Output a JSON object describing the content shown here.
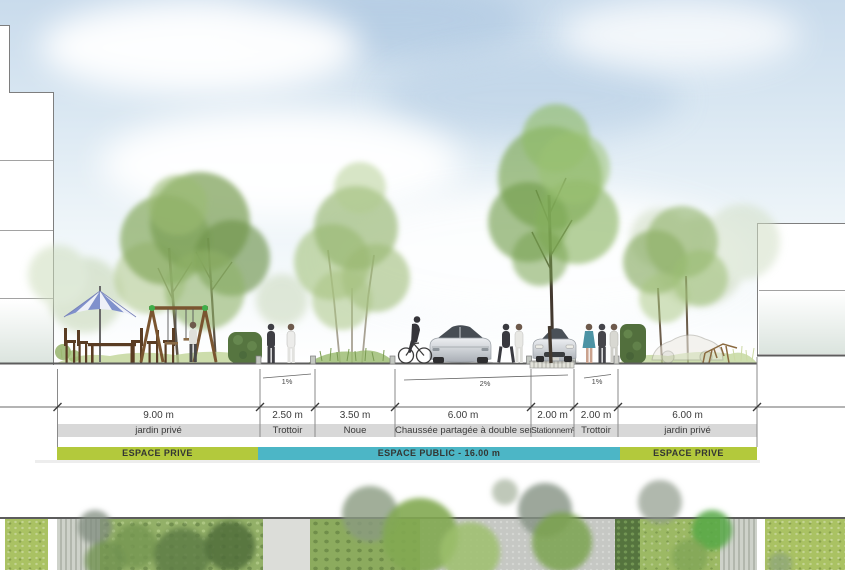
{
  "section": {
    "columns": [
      {
        "dimension": "9.00 m",
        "label": "jardin privé"
      },
      {
        "dimension": "2.50 m",
        "label": "Trottoir"
      },
      {
        "dimension": "3.50 m",
        "label": "Noue"
      },
      {
        "dimension": "6.00 m",
        "label": "Chaussée partagée à double sens"
      },
      {
        "dimension": "2.00 m",
        "label": "Stationnemᵗ"
      },
      {
        "dimension": "2.00 m",
        "label": "Trottoir"
      },
      {
        "dimension": "6.00 m",
        "label": "jardin privé"
      }
    ],
    "zones": [
      {
        "label": "ESPACE PRIVE",
        "color": "#b3c93c"
      },
      {
        "label": "ESPACE PUBLIC - 16.00 m",
        "color": "#4cb6c6"
      },
      {
        "label": "ESPACE PRIVE",
        "color": "#b3c93c"
      }
    ],
    "slopes": [
      {
        "label": "1%"
      },
      {
        "label": "2%"
      },
      {
        "label": "1%"
      }
    ],
    "total_public_width": "16.00 m"
  },
  "colors": {
    "espace_prive_green": "#b3c93c",
    "espace_public_teal": "#4cb6c6",
    "label_band_grey": "#d8d8d8",
    "sky_blue": "#c9dbec"
  }
}
